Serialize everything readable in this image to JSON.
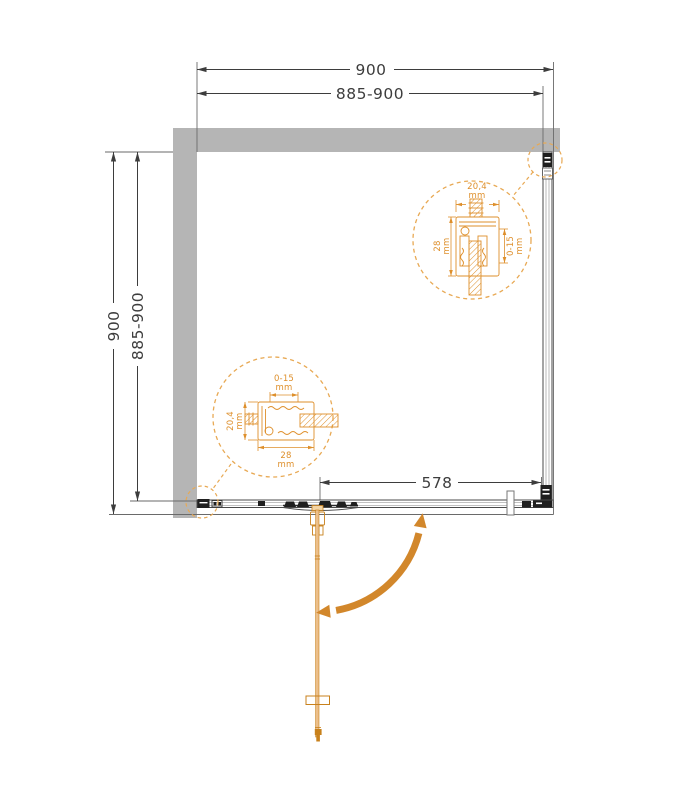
{
  "diagram": {
    "type": "shower-enclosure-plan-view",
    "dims": {
      "top_outer": "900",
      "top_inner": "885-900",
      "left_outer": "900",
      "left_inner": "885-900",
      "door_opening": "578"
    },
    "detail_top_right": {
      "width": {
        "value": "20,4",
        "unit": "mm"
      },
      "height": {
        "value": "28",
        "unit": "mm"
      },
      "adjust": {
        "value": "0-15",
        "unit": "mm"
      }
    },
    "detail_bottom_left": {
      "adjust": {
        "value": "0-15",
        "unit": "mm"
      },
      "height": {
        "value": "20,4",
        "unit": "mm"
      },
      "width": {
        "value": "28",
        "unit": "mm"
      }
    },
    "colors": {
      "wall": "#b5b5b5",
      "line": "#3d3d3d",
      "accent": "#de8f2b",
      "accent_light": "#e8a954",
      "arrow": "#d2872b",
      "door_fill": "#ecbf8a",
      "door_dark": "#c8811c"
    }
  }
}
